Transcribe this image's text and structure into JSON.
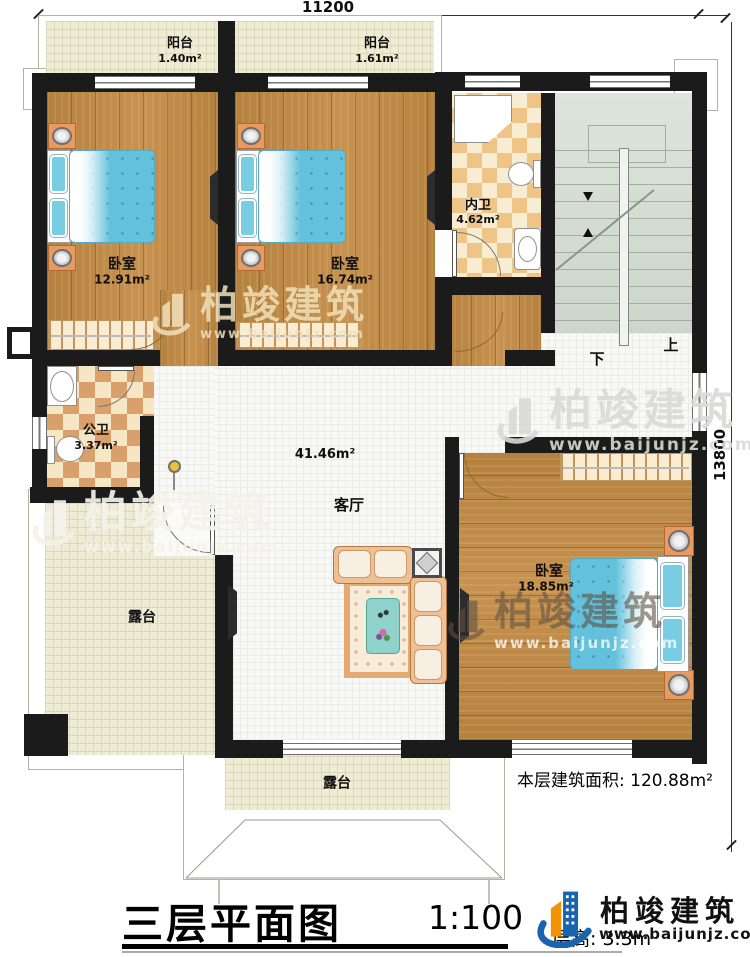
{
  "dimensions": {
    "top": "11200",
    "right": "13800"
  },
  "rooms": {
    "balcony1": {
      "name": "阳台",
      "area": "1.40m²"
    },
    "balcony2": {
      "name": "阳台",
      "area": "1.61m²"
    },
    "bedroom1": {
      "name": "卧室",
      "area": "12.91m²"
    },
    "bedroom2": {
      "name": "卧室",
      "area": "16.74m²"
    },
    "bedroom3": {
      "name": "卧室",
      "area": "18.85m²"
    },
    "bath_ensuite": {
      "name": "内卫",
      "area": "4.62m²"
    },
    "bath_public": {
      "name": "公卫",
      "area": "3.37m²"
    },
    "living": {
      "name": "客厅",
      "area": "41.46m²"
    },
    "terrace_left": {
      "name": "露台"
    },
    "terrace_bottom": {
      "name": "露台"
    }
  },
  "stairs": {
    "up": "上",
    "down": "下"
  },
  "footer": {
    "floor_area_label": "本层建筑面积:",
    "floor_area_value": "120.88m²",
    "title": "三层平面图",
    "scale": "1:100",
    "floor_height": "层高: 3.3m"
  },
  "brand": {
    "name": "柏竣建筑",
    "url": "www.baijunjz.com"
  },
  "watermark": {
    "name": "柏竣建筑",
    "url": "www.baijunjz.com"
  },
  "colors": {
    "wall": "#1b1b1b",
    "wood": "#bb8746",
    "tile": "#f8f8f6",
    "terrace": "#efecd5",
    "checker_warm": "#efc587",
    "checker_brown": "#d9a06b",
    "stair": "#cdd6ca",
    "bed_blue": "#63c1dc",
    "accent_blue": "#1a63ad",
    "accent_orange": "#f29200"
  }
}
